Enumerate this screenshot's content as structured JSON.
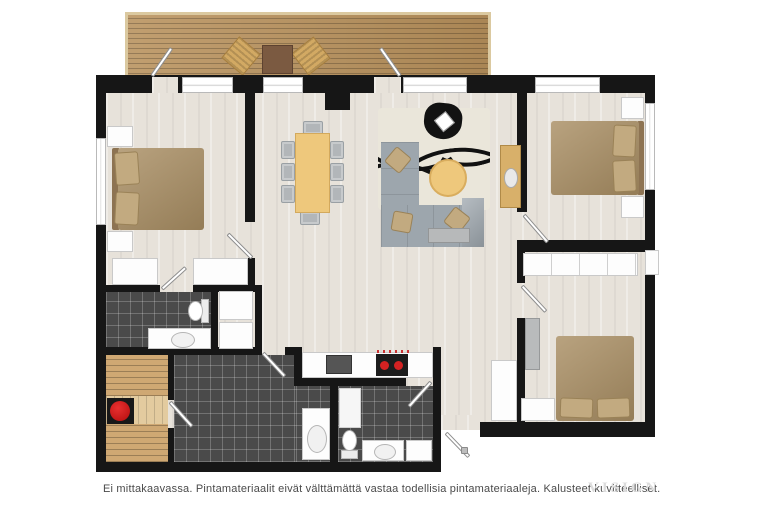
{
  "caption": {
    "text": "Ei mittakaavassa. Pintamateriaalit eivät välttämättä vastaa todellisia pintamateriaaleja. Kalusteet kuvitteelliset."
  },
  "watermark": {
    "text": "VISIGN"
  },
  "palette": {
    "wall": "#161616",
    "floor_light": "#e7e2da",
    "tile_dark": "#4a4a4a",
    "deck_wood": "#b8915c",
    "sauna_bench": "#cfa873",
    "bed_tan": "#a98e63",
    "sofa_gray": "#9da6ad",
    "table_tan": "#eec87c",
    "accent_red": "#cf1414",
    "caption_text": "#4a4a4a",
    "watermark_gray": "#dcdcdc"
  },
  "plan": {
    "type": "apartment-floor-plan-3d-top-view",
    "rooms": [
      {
        "name": "deck",
        "furniture": [
          "lounge-chair",
          "lounge-chair",
          "outdoor-table"
        ]
      },
      {
        "name": "bedroom-master",
        "furniture": [
          "double-bed",
          "nightstand",
          "nightstand",
          "wardrobe",
          "wardrobe"
        ]
      },
      {
        "name": "ensuite-bathroom",
        "furniture": [
          "toilet",
          "sink-vanity",
          "cabinet",
          "cabinet"
        ]
      },
      {
        "name": "sauna",
        "furniture": [
          "bench",
          "bench",
          "sauna-heater"
        ]
      },
      {
        "name": "shower-room",
        "furniture": [
          "sink-vanity"
        ]
      },
      {
        "name": "kitchen",
        "furniture": [
          "counter",
          "sink",
          "cooktop"
        ]
      },
      {
        "name": "dining-area",
        "furniture": [
          "dining-table",
          "chair",
          "chair",
          "chair",
          "chair",
          "chair",
          "chair",
          "chair",
          "chair"
        ]
      },
      {
        "name": "living-room",
        "furniture": [
          "corner-sofa",
          "rug",
          "coffee-table",
          "armchair",
          "sideboard",
          "cabinet"
        ]
      },
      {
        "name": "bedroom-2",
        "furniture": [
          "double-bed",
          "nightstand",
          "nightstand"
        ]
      },
      {
        "name": "bedroom-3",
        "furniture": [
          "double-bed",
          "closet-row",
          "dresser",
          "wardrobe"
        ]
      },
      {
        "name": "hallway",
        "furniture": [
          "closet"
        ]
      },
      {
        "name": "bathroom-2",
        "furniture": [
          "toilet",
          "sink-vanity",
          "cabinet",
          "shower-cabinet"
        ]
      }
    ],
    "door_count": 10,
    "window_count": 7
  }
}
